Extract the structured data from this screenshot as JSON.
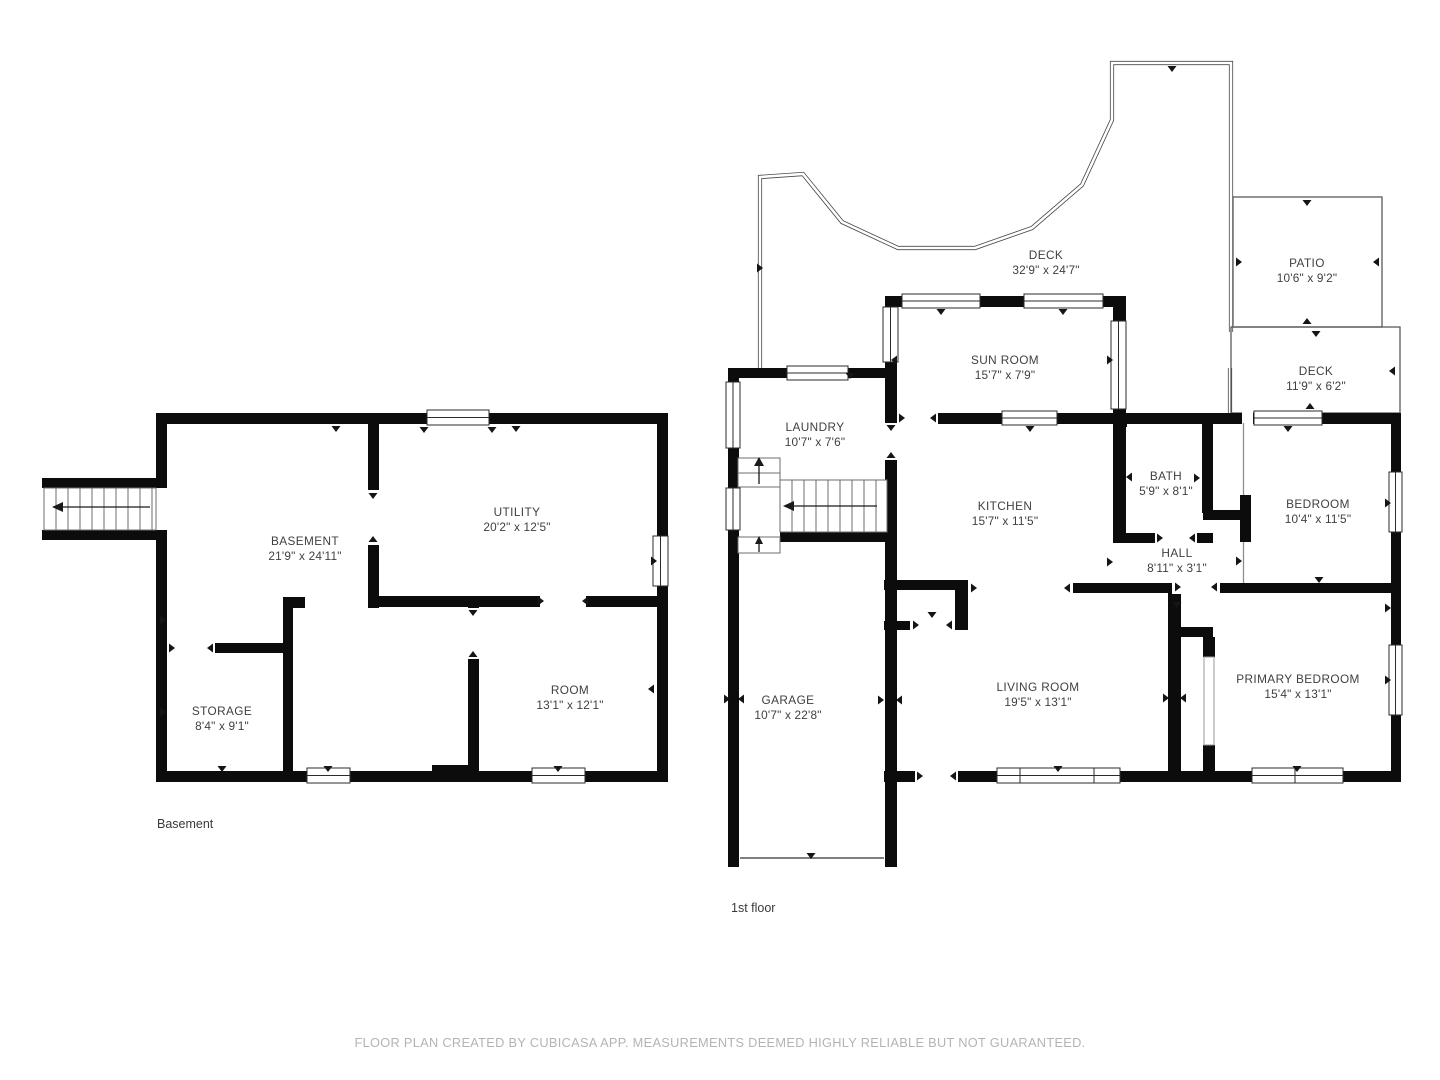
{
  "floors": {
    "basement": {
      "label": "Basement",
      "rooms": {
        "basement": {
          "name": "BASEMENT",
          "dims": "21'9\" x 24'11\""
        },
        "utility": {
          "name": "UTILITY",
          "dims": "20'2\" x 12'5\""
        },
        "storage": {
          "name": "STORAGE",
          "dims": "8'4\" x 9'1\""
        },
        "room": {
          "name": "ROOM",
          "dims": "13'1\" x 12'1\""
        }
      }
    },
    "first": {
      "label": "1st floor",
      "rooms": {
        "deck": {
          "name": "DECK",
          "dims": "32'9\" x 24'7\""
        },
        "patio": {
          "name": "PATIO",
          "dims": "10'6\" x 9'2\""
        },
        "sunroom": {
          "name": "SUN ROOM",
          "dims": "15'7\" x 7'9\""
        },
        "deck2": {
          "name": "DECK",
          "dims": "11'9\" x 6'2\""
        },
        "laundry": {
          "name": "LAUNDRY",
          "dims": "10'7\" x 7'6\""
        },
        "kitchen": {
          "name": "KITCHEN",
          "dims": "15'7\" x 11'5\""
        },
        "bath": {
          "name": "BATH",
          "dims": "5'9\" x 8'1\""
        },
        "bedroom": {
          "name": "BEDROOM",
          "dims": "10'4\" x 11'5\""
        },
        "hall": {
          "name": "HALL",
          "dims": "8'11\" x 3'1\""
        },
        "garage": {
          "name": "GARAGE",
          "dims": "10'7\" x 22'8\""
        },
        "living": {
          "name": "LIVING ROOM",
          "dims": "19'5\" x 13'1\""
        },
        "primary": {
          "name": "PRIMARY BEDROOM",
          "dims": "15'4\" x 13'1\""
        }
      }
    }
  },
  "footer": {
    "disclaimer": "FLOOR PLAN CREATED BY CUBICASA APP. MEASUREMENTS DEEMED HIGHLY RELIABLE BUT NOT GUARANTEED."
  },
  "colors": {
    "wall": "#0c0c0c",
    "text": "#3f3f3f",
    "muted": "#b4b4b4"
  }
}
